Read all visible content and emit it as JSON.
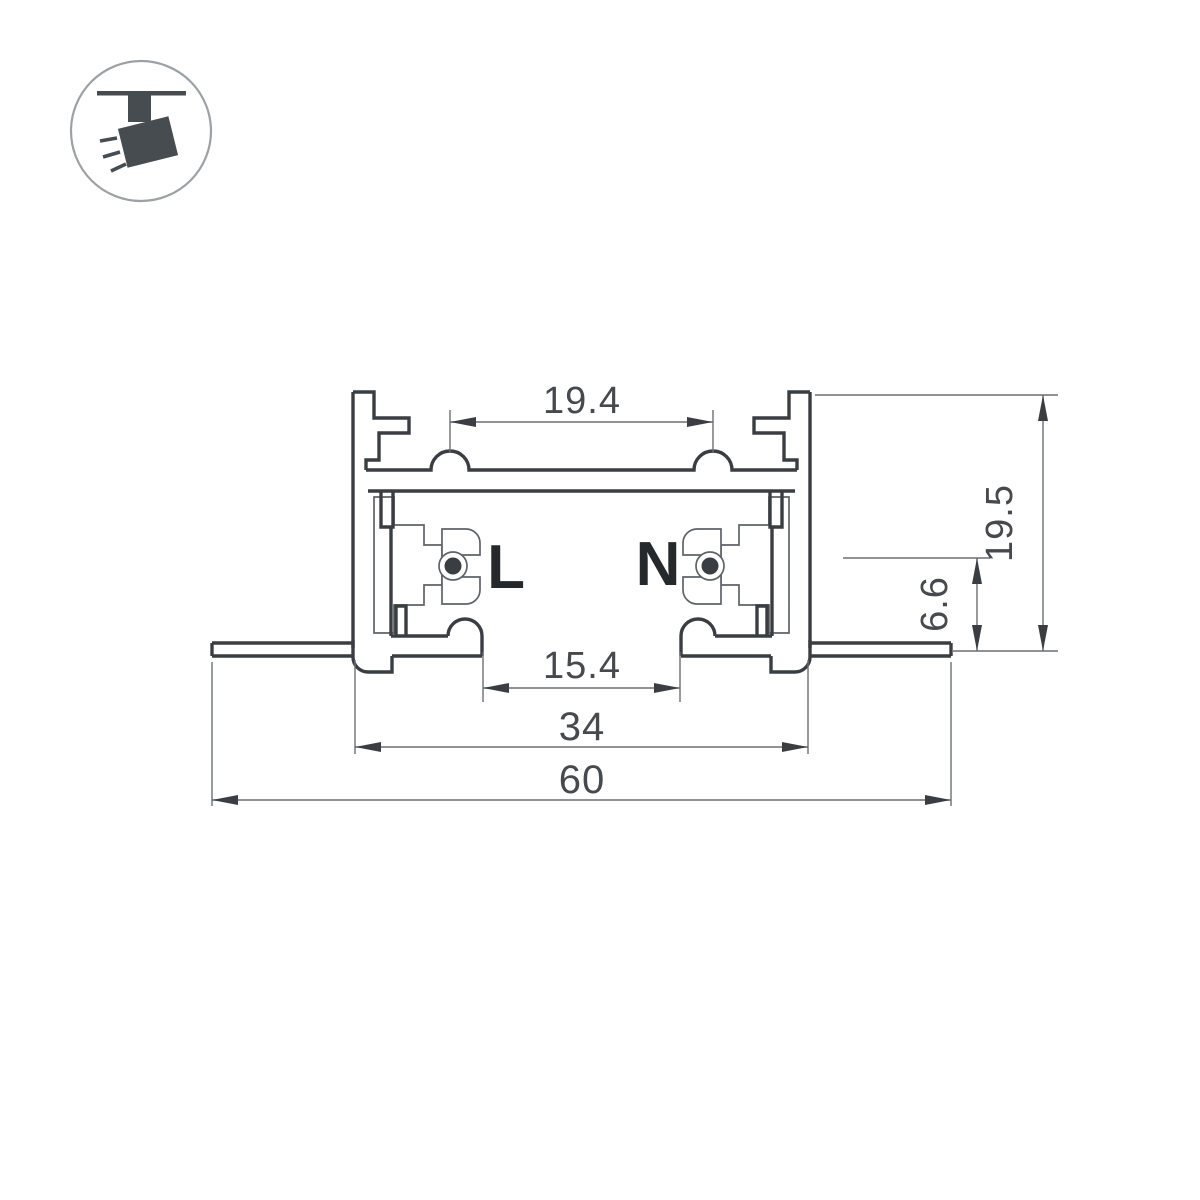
{
  "drawing": {
    "type": "track-profile-cross-section",
    "background": "#ffffff",
    "line_color": "#3a3e42",
    "thin_line_color": "#5f6367",
    "dim_line_color": "#6b6f73",
    "dim_text_color": "#46494d",
    "label_color": "#26292c"
  },
  "icon": {
    "name": "ceiling-track-spotlight",
    "color": "#474c51",
    "circle_color": "#9ca1a6"
  },
  "conductor_labels": {
    "live": "L",
    "neutral": "N"
  },
  "dimensions": {
    "top_span": "19.4",
    "slot": "15.4",
    "body": "34",
    "overall": "60",
    "height": "19.5",
    "contact": "6.6"
  }
}
